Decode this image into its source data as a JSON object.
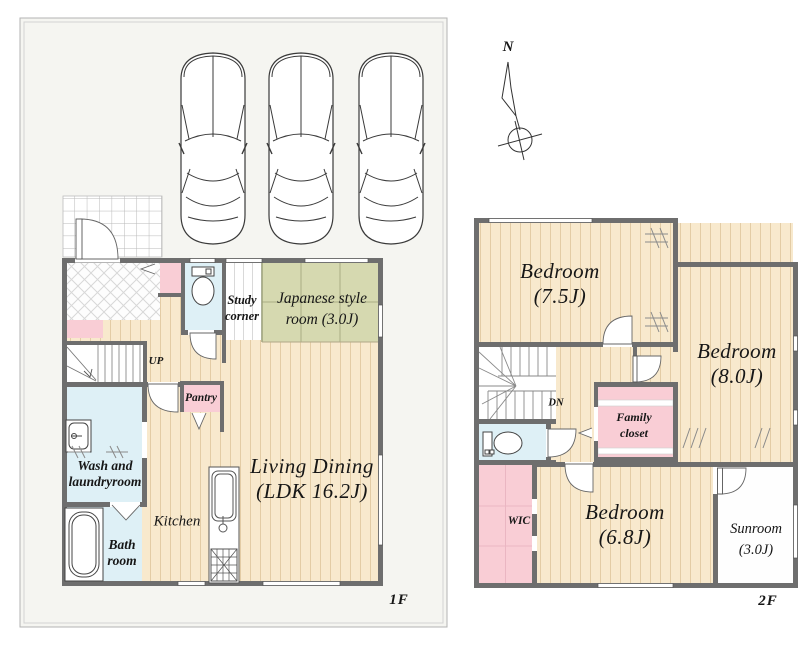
{
  "compass": {
    "north": "N"
  },
  "floor1": {
    "floor_label": "1F",
    "parking_spaces": 3,
    "rooms": {
      "study": {
        "l1": "Study",
        "l2": "corner"
      },
      "japanese": {
        "l1": "Japanese style",
        "l2": "room (3.0J)"
      },
      "stairs_up": "UP",
      "pantry": "Pantry",
      "wash": {
        "l1": "Wash and",
        "l2": "laundryroom"
      },
      "bath": {
        "l1": "Bath",
        "l2": "room"
      },
      "kitchen": "Kitchen",
      "living": {
        "l1": "Living Dining",
        "l2": "(LDK 16.2J)"
      }
    }
  },
  "floor2": {
    "floor_label": "2F",
    "rooms": {
      "bedroom75": {
        "l1": "Bedroom",
        "l2": "(7.5J)"
      },
      "bedroom80": {
        "l1": "Bedroom",
        "l2": "(8.0J)"
      },
      "stairs_down": "DN",
      "family_closet": {
        "l1": "Family",
        "l2": "closet"
      },
      "wic": "WIC",
      "bedroom68": {
        "l1": "Bedroom",
        "l2": "(6.8J)"
      },
      "sunroom": {
        "l1": "Sunroom",
        "l2": "(3.0J)"
      }
    }
  },
  "colors": {
    "wall": "#6e6e6e",
    "wood_floor": "#f8e9cd",
    "tatami": "#d6d9b0",
    "wet_area": "#def0f6",
    "storage_pink": "#f9cdd5",
    "frame_bg": "#f5f5f1"
  }
}
